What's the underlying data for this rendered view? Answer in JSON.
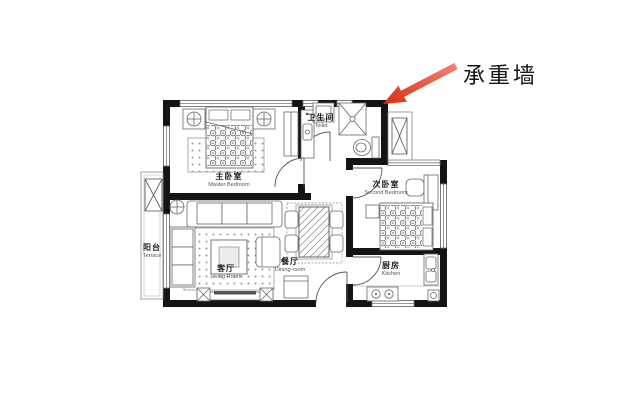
{
  "annotation": {
    "text": "承重墙"
  },
  "rooms": {
    "master_bedroom": {
      "zh": "主卧室",
      "en": "Master Bedroom"
    },
    "toilet": {
      "zh": "卫生间",
      "en": "Toilet"
    },
    "second_bedroom": {
      "zh": "次卧室",
      "en": "Second Bedroom"
    },
    "kitchen": {
      "zh": "厨房",
      "en": "Kitchen"
    },
    "living_room": {
      "zh": "客厅",
      "en": "Living Room"
    },
    "dining_room": {
      "zh": "餐厅",
      "en": "Dining-room"
    },
    "terrace": {
      "zh": "阳台",
      "en": "Terrace"
    }
  },
  "colors": {
    "wall": "#141414",
    "furniture_stroke": "#666666",
    "window_stroke": "#777777",
    "arrow": "#e23a1f",
    "background": "#ffffff"
  },
  "icons": [
    "double-bed",
    "nightstand-lamp",
    "wardrobe",
    "rug",
    "washing-machine",
    "shower",
    "toilet-bowl",
    "bathroom-sink",
    "single-bed",
    "desk",
    "chair",
    "kitchen-stove",
    "kitchen-sink",
    "floor-drain",
    "sofa",
    "chaise",
    "coffee-table",
    "armchair",
    "floor-lamp",
    "tv-stand",
    "speaker",
    "dining-table",
    "dining-chair",
    "shoe-cabinet",
    "ac-unit",
    "door-arc",
    "window",
    "load-bearing-wall-arrow"
  ]
}
